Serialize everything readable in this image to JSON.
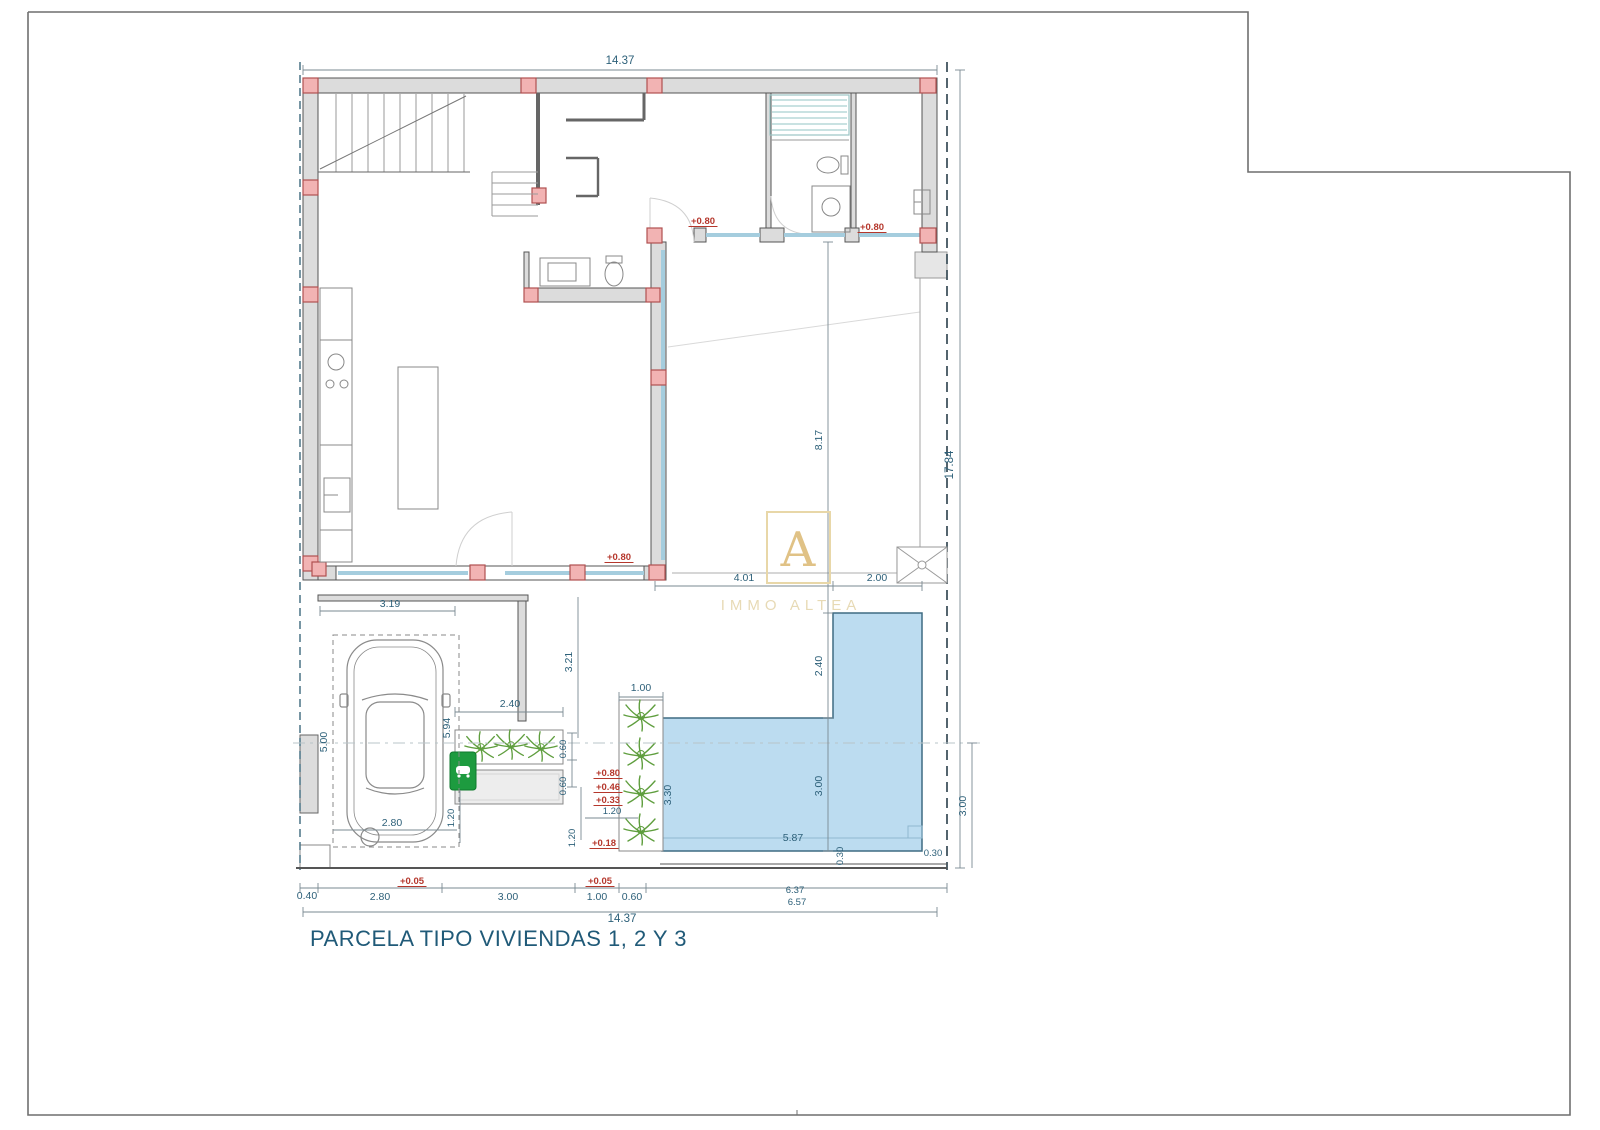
{
  "title": "PARCELA TIPO VIVIENDAS 1, 2 Y 3",
  "watermark": {
    "letter": "A",
    "name": "IMMO ALTEA"
  },
  "colors": {
    "wall_fill": "#dcdcdc",
    "wall_stroke": "#555555",
    "column_fill": "#f2b3b3",
    "column_stroke": "#b05050",
    "glazing": "#a5cdde",
    "pool_fill": "#bcdcf0",
    "pool_stroke": "#3f6b82",
    "plant_green": "#5f9e3e",
    "dim_text": "#2d6079",
    "level_text": "#b5372c",
    "title_text": "#205a78",
    "watermark_gold": "#d9b469",
    "ev_box_green": "#1d9b3f"
  },
  "labels": [
    {
      "t": "14.37",
      "x": 620,
      "y": 64,
      "r": 0,
      "c": "dim-big"
    },
    {
      "t": "14.37",
      "x": 622,
      "y": 922,
      "r": 0,
      "c": "dim-big"
    },
    {
      "t": "17.84",
      "x": 953,
      "y": 465,
      "r": 1,
      "c": "dim-big"
    },
    {
      "t": "8.17",
      "x": 822,
      "y": 440,
      "r": 1,
      "c": "dim"
    },
    {
      "t": "2.40",
      "x": 822,
      "y": 666,
      "r": 1,
      "c": "dim"
    },
    {
      "t": "3.00",
      "x": 822,
      "y": 786,
      "r": 1,
      "c": "dim"
    },
    {
      "t": "3.30",
      "x": 671,
      "y": 795,
      "r": 1,
      "c": "dim"
    },
    {
      "t": "5.87",
      "x": 793,
      "y": 841,
      "r": 0,
      "c": "dim"
    },
    {
      "t": "0.30",
      "x": 843,
      "y": 856,
      "r": 1,
      "c": "dim-small"
    },
    {
      "t": "0.30",
      "x": 933,
      "y": 856,
      "r": 0,
      "c": "dim-small"
    },
    {
      "t": "3.00",
      "x": 966,
      "y": 806,
      "r": 1,
      "c": "dim"
    },
    {
      "t": "4.01",
      "x": 744,
      "y": 581,
      "r": 0,
      "c": "dim"
    },
    {
      "t": "2.00",
      "x": 877,
      "y": 581,
      "r": 0,
      "c": "dim"
    },
    {
      "t": "1.00",
      "x": 641,
      "y": 691,
      "r": 0,
      "c": "dim"
    },
    {
      "t": "3.19",
      "x": 390,
      "y": 607,
      "r": 0,
      "c": "dim"
    },
    {
      "t": "5.00",
      "x": 327,
      "y": 742,
      "r": 1,
      "c": "dim"
    },
    {
      "t": "5.94",
      "x": 450,
      "y": 728,
      "r": 1,
      "c": "dim"
    },
    {
      "t": "2.80",
      "x": 392,
      "y": 826,
      "r": 0,
      "c": "dim"
    },
    {
      "t": "3.21",
      "x": 572,
      "y": 662,
      "r": 1,
      "c": "dim"
    },
    {
      "t": "2.40",
      "x": 510,
      "y": 707,
      "r": 0,
      "c": "dim"
    },
    {
      "t": "0.60",
      "x": 566,
      "y": 749,
      "r": 1,
      "c": "dim-small"
    },
    {
      "t": "0.60",
      "x": 566,
      "y": 786,
      "r": 1,
      "c": "dim-small"
    },
    {
      "t": "1.20",
      "x": 612,
      "y": 814,
      "r": 0,
      "c": "dim-small"
    },
    {
      "t": "1.20",
      "x": 575,
      "y": 838,
      "r": 1,
      "c": "dim-small"
    },
    {
      "t": "1.20",
      "x": 454,
      "y": 818,
      "r": 1,
      "c": "dim-small"
    },
    {
      "t": "0.40",
      "x": 307,
      "y": 899,
      "r": 0,
      "c": "dim"
    },
    {
      "t": "2.80",
      "x": 380,
      "y": 900,
      "r": 0,
      "c": "dim"
    },
    {
      "t": "3.00",
      "x": 508,
      "y": 900,
      "r": 0,
      "c": "dim"
    },
    {
      "t": "1.00",
      "x": 597,
      "y": 900,
      "r": 0,
      "c": "dim"
    },
    {
      "t": "0.60",
      "x": 632,
      "y": 900,
      "r": 0,
      "c": "dim"
    },
    {
      "t": "6.37",
      "x": 795,
      "y": 893,
      "r": 0,
      "c": "dim-small"
    },
    {
      "t": "6.57",
      "x": 797,
      "y": 905,
      "r": 0,
      "c": "dim-small"
    },
    {
      "t": "+0.80",
      "x": 703,
      "y": 224,
      "r": 0,
      "c": "lvl"
    },
    {
      "t": "+0.80",
      "x": 872,
      "y": 230,
      "r": 0,
      "c": "lvl"
    },
    {
      "t": "+0.80",
      "x": 619,
      "y": 560,
      "r": 0,
      "c": "lvl"
    },
    {
      "t": "+0.80",
      "x": 608,
      "y": 776,
      "r": 0,
      "c": "lvl"
    },
    {
      "t": "+0.46",
      "x": 608,
      "y": 790,
      "r": 0,
      "c": "lvl"
    },
    {
      "t": "+0.33",
      "x": 608,
      "y": 803,
      "r": 0,
      "c": "lvl"
    },
    {
      "t": "+0.18",
      "x": 604,
      "y": 846,
      "r": 0,
      "c": "lvl"
    },
    {
      "t": "+0.05",
      "x": 412,
      "y": 884,
      "r": 0,
      "c": "lvl"
    },
    {
      "t": "+0.05",
      "x": 600,
      "y": 884,
      "r": 0,
      "c": "lvl"
    }
  ]
}
